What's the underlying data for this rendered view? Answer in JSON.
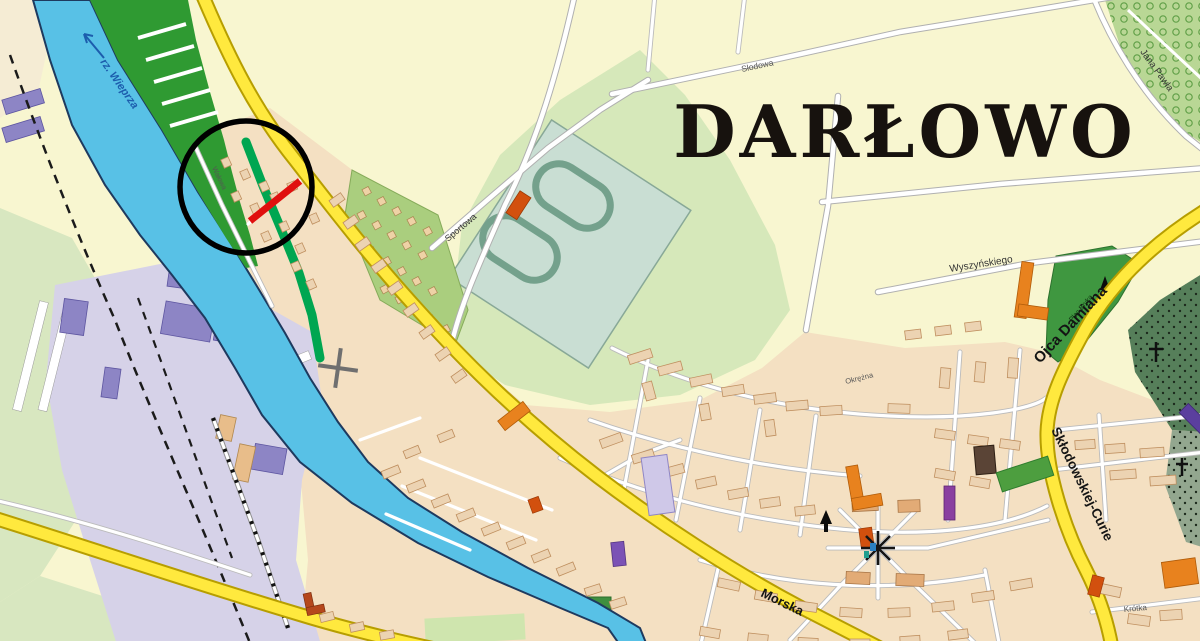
{
  "map": {
    "labels": {
      "title": "DARŁOWO",
      "river": "rz. Wieprza",
      "morska": "Morska",
      "ojca_damiana": "Ojca Damiana",
      "sklodowskiej_curie": "Skłodowskiej-Curie",
      "wyszynskiego": "Wyszyńskiego",
      "jana_pawla": "Jana Pawła",
      "slodowa": "Słodowa",
      "sportowa": "Sportowa",
      "okrezna": "Okrężna",
      "walowa": "Wałowa",
      "krotka": "Krótka",
      "plac_eryka": "Plac Eryka"
    },
    "annotation": {
      "highlight_circle_color": "#000000",
      "highlighted_segment_color": "#e0100e"
    },
    "colors": {
      "field_yellow": "#f8f6d0",
      "urban_tan": "#f4e0c2",
      "meadow_green": "#d8e7c0",
      "park_green": "#d6e8ba",
      "embankment_green": "#2f9a32",
      "promenade_green": "#00a651",
      "river_blue": "#58c1e6",
      "port_lavender": "#d6d2e8",
      "road_yellow": "#ffe93e",
      "stadium_teal": "#c9ded3"
    }
  }
}
